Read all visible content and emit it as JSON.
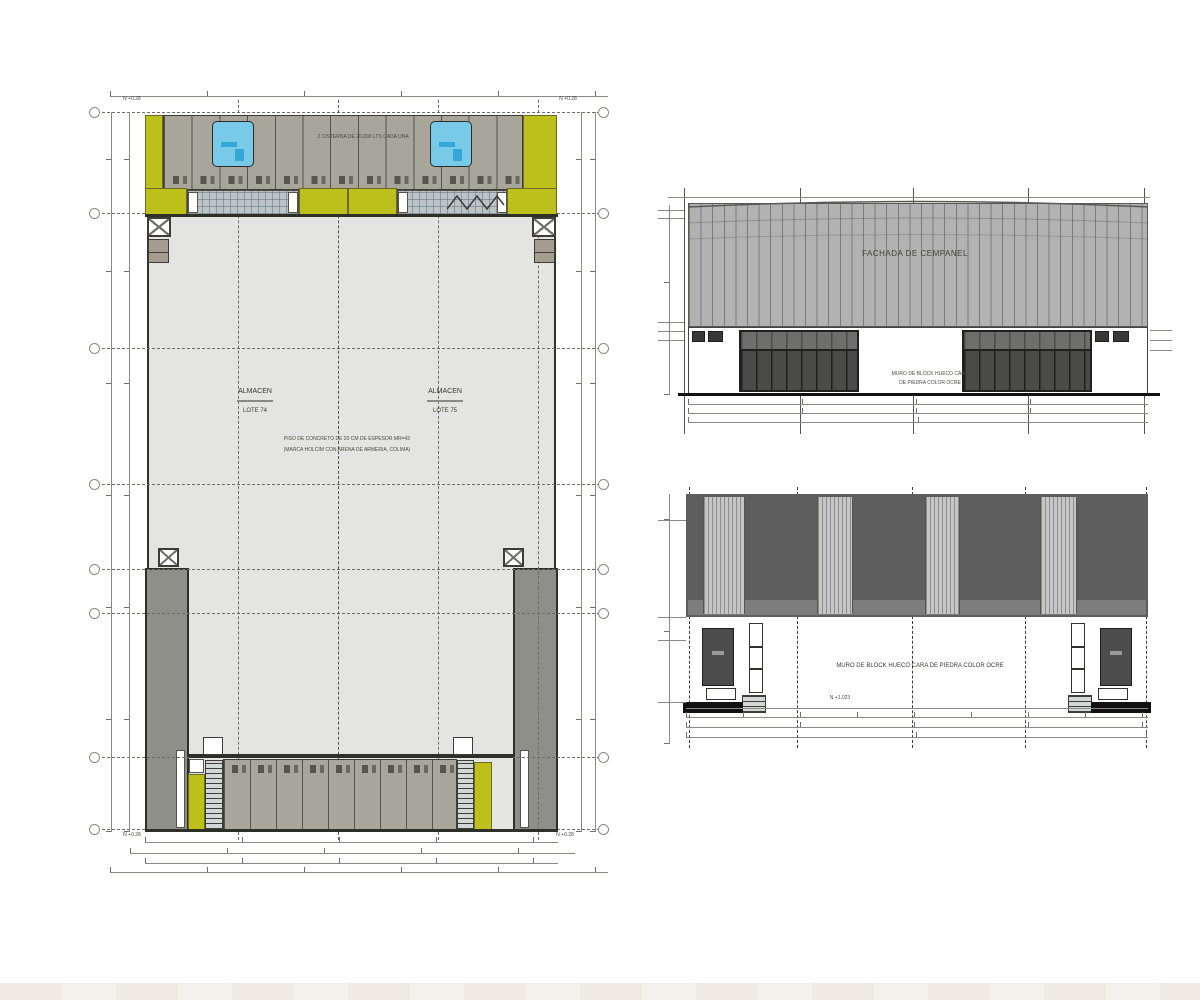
{
  "plan": {
    "cistern_note": "2 CISTERNA DE 20,000 LTS CADA UNA",
    "level_top_left": "N +0.28",
    "level_top_right": "N +0.28",
    "level_bottom_left": "N +0.28",
    "level_bottom_right": "N +0.28",
    "lot_left": {
      "name": "ALMACEN",
      "lot": "LOTE 74"
    },
    "lot_right": {
      "name": "ALMACEN",
      "lot": "LOTE 75"
    },
    "floor_note_line1": "PISO DE CONCRETO DE 20 CM DE ESPESOR MR=42",
    "floor_note_line2": "(MARCA HOLCIM CON ARENA DE ARMERIA, COLIMA)"
  },
  "elevation_front": {
    "title": "FACHADA DE CEMPANEL",
    "wall_note_line1": "MURO DE BLOCK HUECO CARA",
    "wall_note_line2": "DE PIEDRA COLOR OCRE"
  },
  "elevation_rear": {
    "wall_note": "MURO DE BLOCK HUECO CARA DE PIEDRA COLOR OCRE",
    "level_note": "N +1.023"
  },
  "colors": {
    "accent_yellow": "#bdbf1a",
    "bay_tan": "#a8a59a",
    "cistern_blue": "#79c9e9",
    "floor_gray": "#e4e4e2",
    "wall_gray": "#8f8f89",
    "facade_gray": "#b2b2b2",
    "rear_wall_gray": "#5e5e5e"
  }
}
